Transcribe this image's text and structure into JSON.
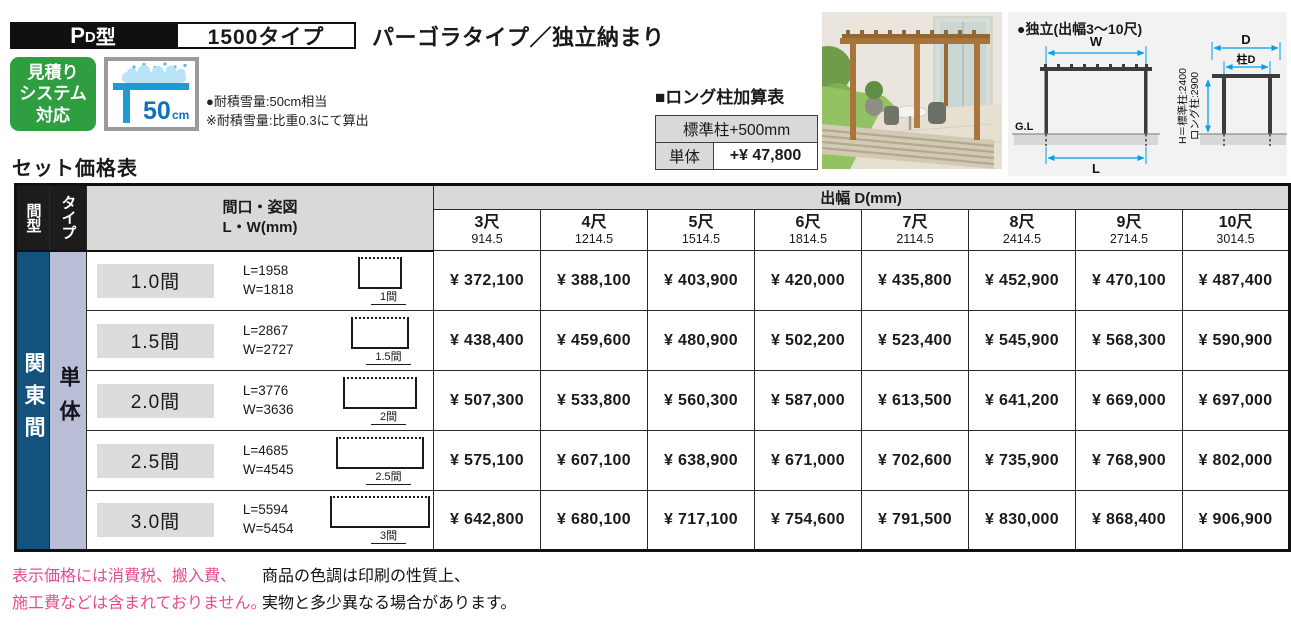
{
  "header": {
    "model_prefix": "P",
    "model_sub": "D",
    "model_suffix": "型",
    "type_box": "1500タイプ",
    "title": "パーゴラタイプ／独立納まり",
    "badge_lines": [
      "見積り",
      "システム",
      "対応"
    ],
    "snow_value": "50",
    "snow_unit": "cm",
    "snow_notes": [
      "●耐積雪量:50cm相当",
      "※耐積雪量:比重0.3にて算出"
    ]
  },
  "addon_table": {
    "title": "■ロング柱加算表",
    "header": "標準柱+500mm",
    "row_label": "単体",
    "row_value": "+¥ 47,800"
  },
  "diagram": {
    "title": "●独立(出幅3〜10尺)",
    "front": {
      "w": "W",
      "l": "L",
      "gl": "G.L"
    },
    "side": {
      "d": "D",
      "pillar_d": "柱D",
      "h_line1": "H＝標準柱:2400",
      "h_line2": "ロング柱:2900"
    }
  },
  "price_table": {
    "title": "セット価格表",
    "col_span_type": "間型",
    "col_type": "タイプ",
    "col_spec_line1": "間口・姿図",
    "col_spec_line2": "L・W(mm)",
    "depth_header": "出幅 D(mm)",
    "depth_cols": [
      {
        "shaku": "3尺",
        "mm": "914.5"
      },
      {
        "shaku": "4尺",
        "mm": "1214.5"
      },
      {
        "shaku": "5尺",
        "mm": "1514.5"
      },
      {
        "shaku": "6尺",
        "mm": "1814.5"
      },
      {
        "shaku": "7尺",
        "mm": "2114.5"
      },
      {
        "shaku": "8尺",
        "mm": "2414.5"
      },
      {
        "shaku": "9尺",
        "mm": "2714.5"
      },
      {
        "shaku": "10尺",
        "mm": "3014.5"
      }
    ],
    "row_group": "関東間",
    "type_group": "単体",
    "rows": [
      {
        "label": "1.0間",
        "l": "L=1958",
        "w": "W=1818",
        "dim": "1間",
        "prices": [
          "¥ 372,100",
          "¥ 388,100",
          "¥ 403,900",
          "¥ 420,000",
          "¥ 435,800",
          "¥ 452,900",
          "¥ 470,100",
          "¥ 487,400"
        ]
      },
      {
        "label": "1.5間",
        "l": "L=2867",
        "w": "W=2727",
        "dim": "1.5間",
        "prices": [
          "¥ 438,400",
          "¥ 459,600",
          "¥ 480,900",
          "¥ 502,200",
          "¥ 523,400",
          "¥ 545,900",
          "¥ 568,300",
          "¥ 590,900"
        ]
      },
      {
        "label": "2.0間",
        "l": "L=3776",
        "w": "W=3636",
        "dim": "2間",
        "prices": [
          "¥ 507,300",
          "¥ 533,800",
          "¥ 560,300",
          "¥ 587,000",
          "¥ 613,500",
          "¥ 641,200",
          "¥ 669,000",
          "¥ 697,000"
        ]
      },
      {
        "label": "2.5間",
        "l": "L=4685",
        "w": "W=4545",
        "dim": "2.5間",
        "prices": [
          "¥ 575,100",
          "¥ 607,100",
          "¥ 638,900",
          "¥ 671,000",
          "¥ 702,600",
          "¥ 735,900",
          "¥ 768,900",
          "¥ 802,000"
        ]
      },
      {
        "label": "3.0間",
        "l": "L=5594",
        "w": "W=5454",
        "dim": "3間",
        "prices": [
          "¥ 642,800",
          "¥ 680,100",
          "¥ 717,100",
          "¥ 754,600",
          "¥ 791,500",
          "¥ 830,000",
          "¥ 868,400",
          "¥ 906,900"
        ]
      }
    ]
  },
  "footnotes": {
    "pink": [
      "表示価格には消費税、搬入費、",
      "施工費などは含まれておりません。"
    ],
    "black": [
      "商品の色調は印刷の性質上、",
      "実物と多少異なる場合があります。"
    ]
  },
  "colors": {
    "badge_green": "#2f9e41",
    "snow_blue": "#1e9bd7",
    "snow_light": "#b9e3f7",
    "snow_text": "#0d72b9",
    "dim_cyan": "#00a0e9",
    "kanto_blue": "#14527e",
    "type_lavender": "#b9bed6",
    "header_gray": "#d9d9d9",
    "note_pink": "#e74b8e"
  }
}
